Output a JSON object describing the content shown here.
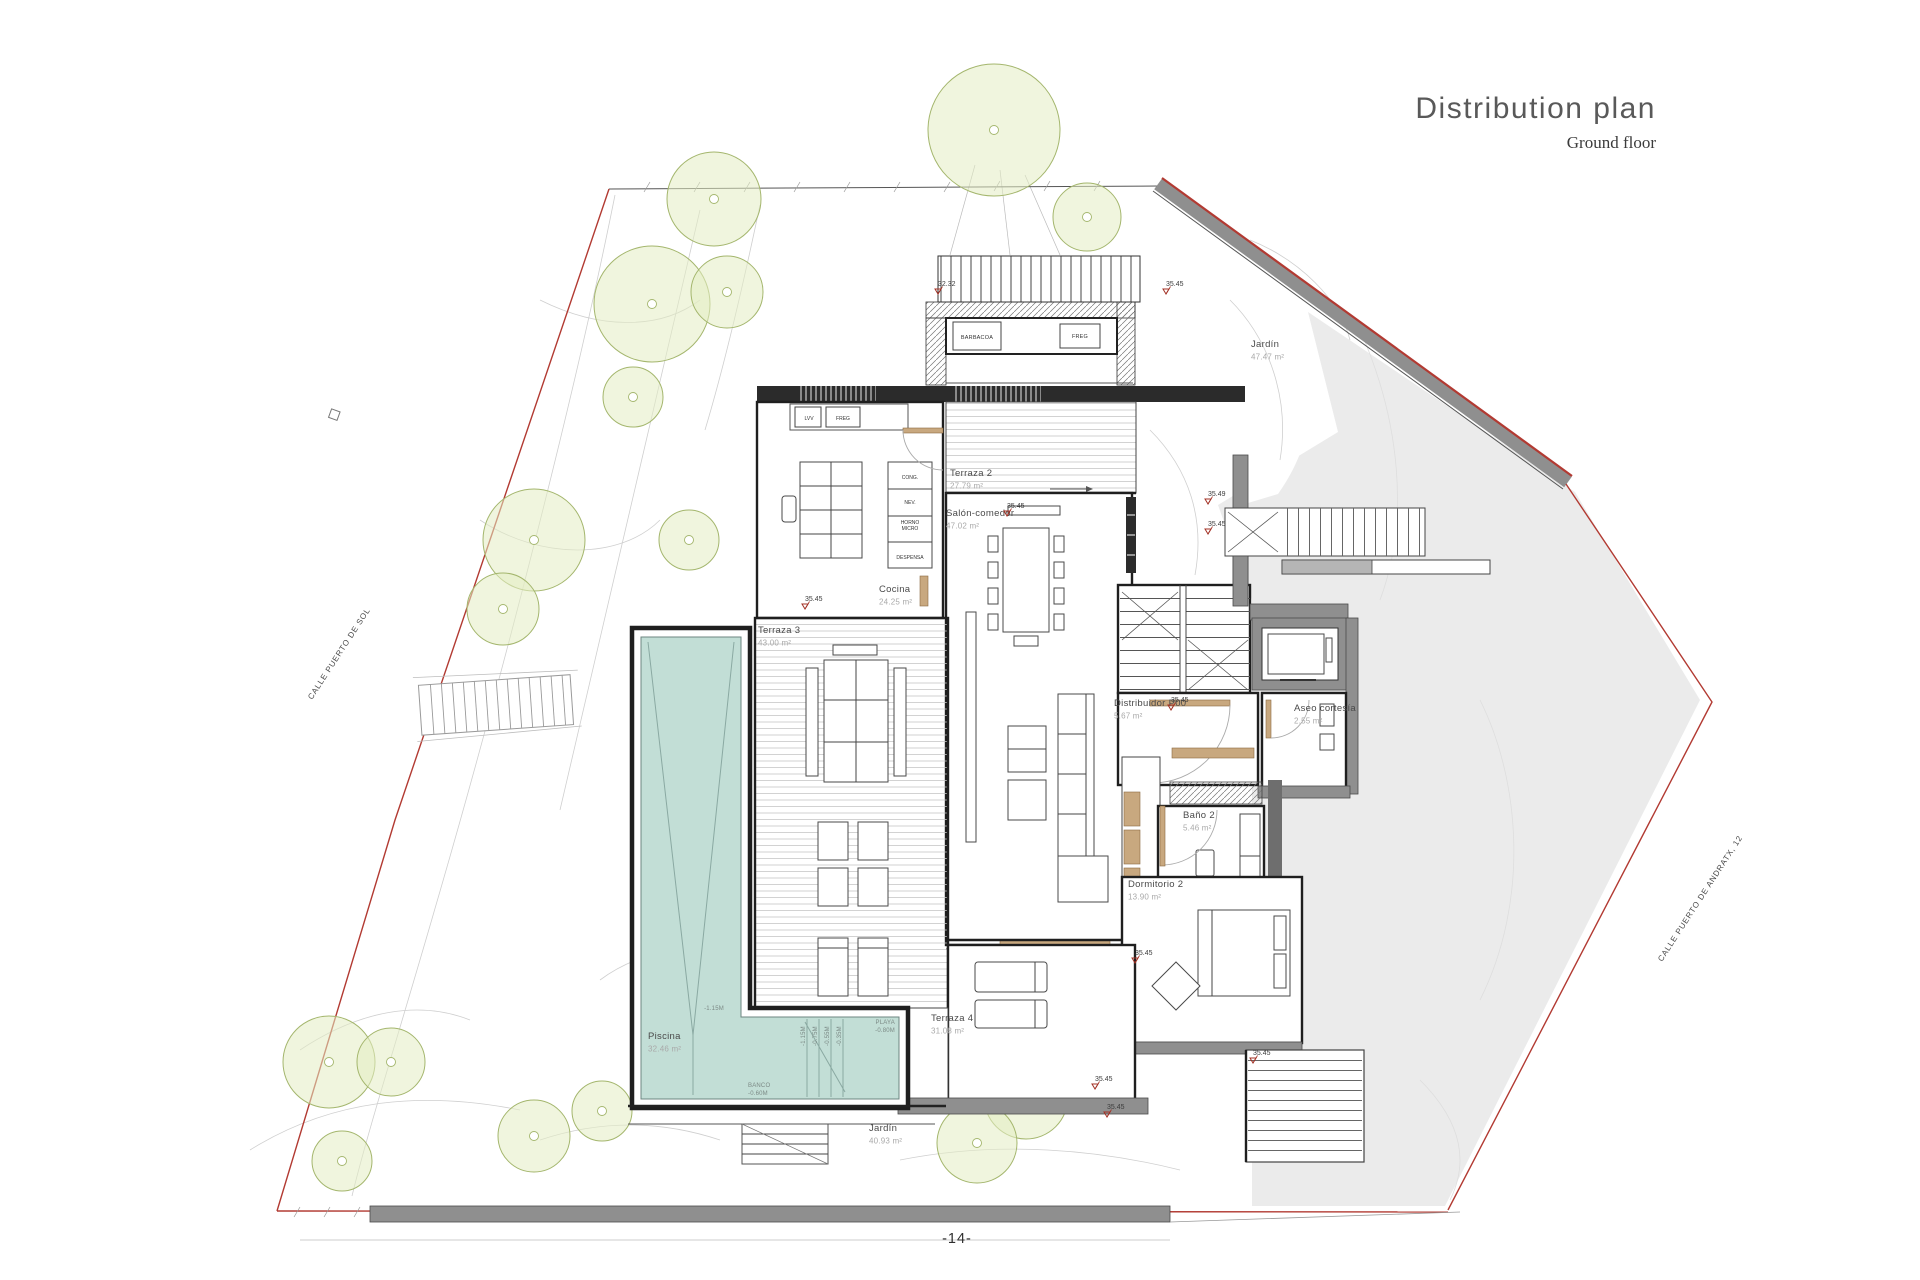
{
  "header": {
    "title": "Distribution plan",
    "subtitle": "Ground floor"
  },
  "footer": {
    "page_number": "-14-"
  },
  "streets": {
    "left": "CALLE PUERTO DE SOL",
    "right": "CALLE PUERTO DE ANDRATX, 12"
  },
  "rooms": [
    {
      "id": "terraza2",
      "name": "Terraza 2",
      "area": "27.79 m²"
    },
    {
      "id": "salon",
      "name": "Salón-comedor",
      "area": "47.02 m²"
    },
    {
      "id": "cocina",
      "name": "Cocina",
      "area": "24.25 m²"
    },
    {
      "id": "terraza3",
      "name": "Terraza 3",
      "area": "43.00 m²"
    },
    {
      "id": "distribuidor",
      "name": "Distribuidor P00",
      "area": "5.67 m²"
    },
    {
      "id": "aseo",
      "name": "Aseo cortesía",
      "area": "2.55 m²"
    },
    {
      "id": "bano2",
      "name": "Baño 2",
      "area": "5.46 m²"
    },
    {
      "id": "dormitorio2",
      "name": "Dormitorio 2",
      "area": "13.90 m²"
    },
    {
      "id": "terraza4",
      "name": "Terraza 4",
      "area": "31.08 m²"
    },
    {
      "id": "piscina",
      "name": "Piscina",
      "area": "32.46 m²"
    },
    {
      "id": "jardin_sur",
      "name": "Jardín",
      "area": "40.93 m²"
    },
    {
      "id": "jardin_norte",
      "name": "Jardín",
      "area": "47.47 m²"
    }
  ],
  "levels": [
    "32.32",
    "35.45",
    "35.49",
    "35.45",
    "35.45",
    "35.45",
    "35.45",
    "35.45",
    "35.45",
    "35.45",
    "35.45"
  ],
  "kitchen": {
    "counter_units": [
      "LVV",
      "FREG"
    ],
    "tall_units": [
      "CONG.",
      "NEV.",
      "HORNO MICRO",
      "DESPENSA"
    ]
  },
  "barbecue": {
    "grill": "BARBACOA",
    "sink": "FREG"
  },
  "pool": {
    "beach": {
      "name": "PLAYA",
      "depth": "-0.80M"
    },
    "bench": {
      "name": "BANCO",
      "depth": "-0.60M"
    },
    "deep_end": "-1.15M",
    "step_depths": [
      "-1.15M",
      "-0.75M",
      "-0.55M",
      "-0.35M"
    ]
  },
  "colors": {
    "boundary_red": "#b23a32",
    "terrain_gray": "#ebebeb",
    "wall_gray": "#8f8f8f",
    "pool_water": "#c2ded6",
    "tree_fill": "#e3ecc3",
    "tree_stroke": "#a4b66d",
    "wood": "#c8a87f",
    "title_gray": "#595959"
  }
}
